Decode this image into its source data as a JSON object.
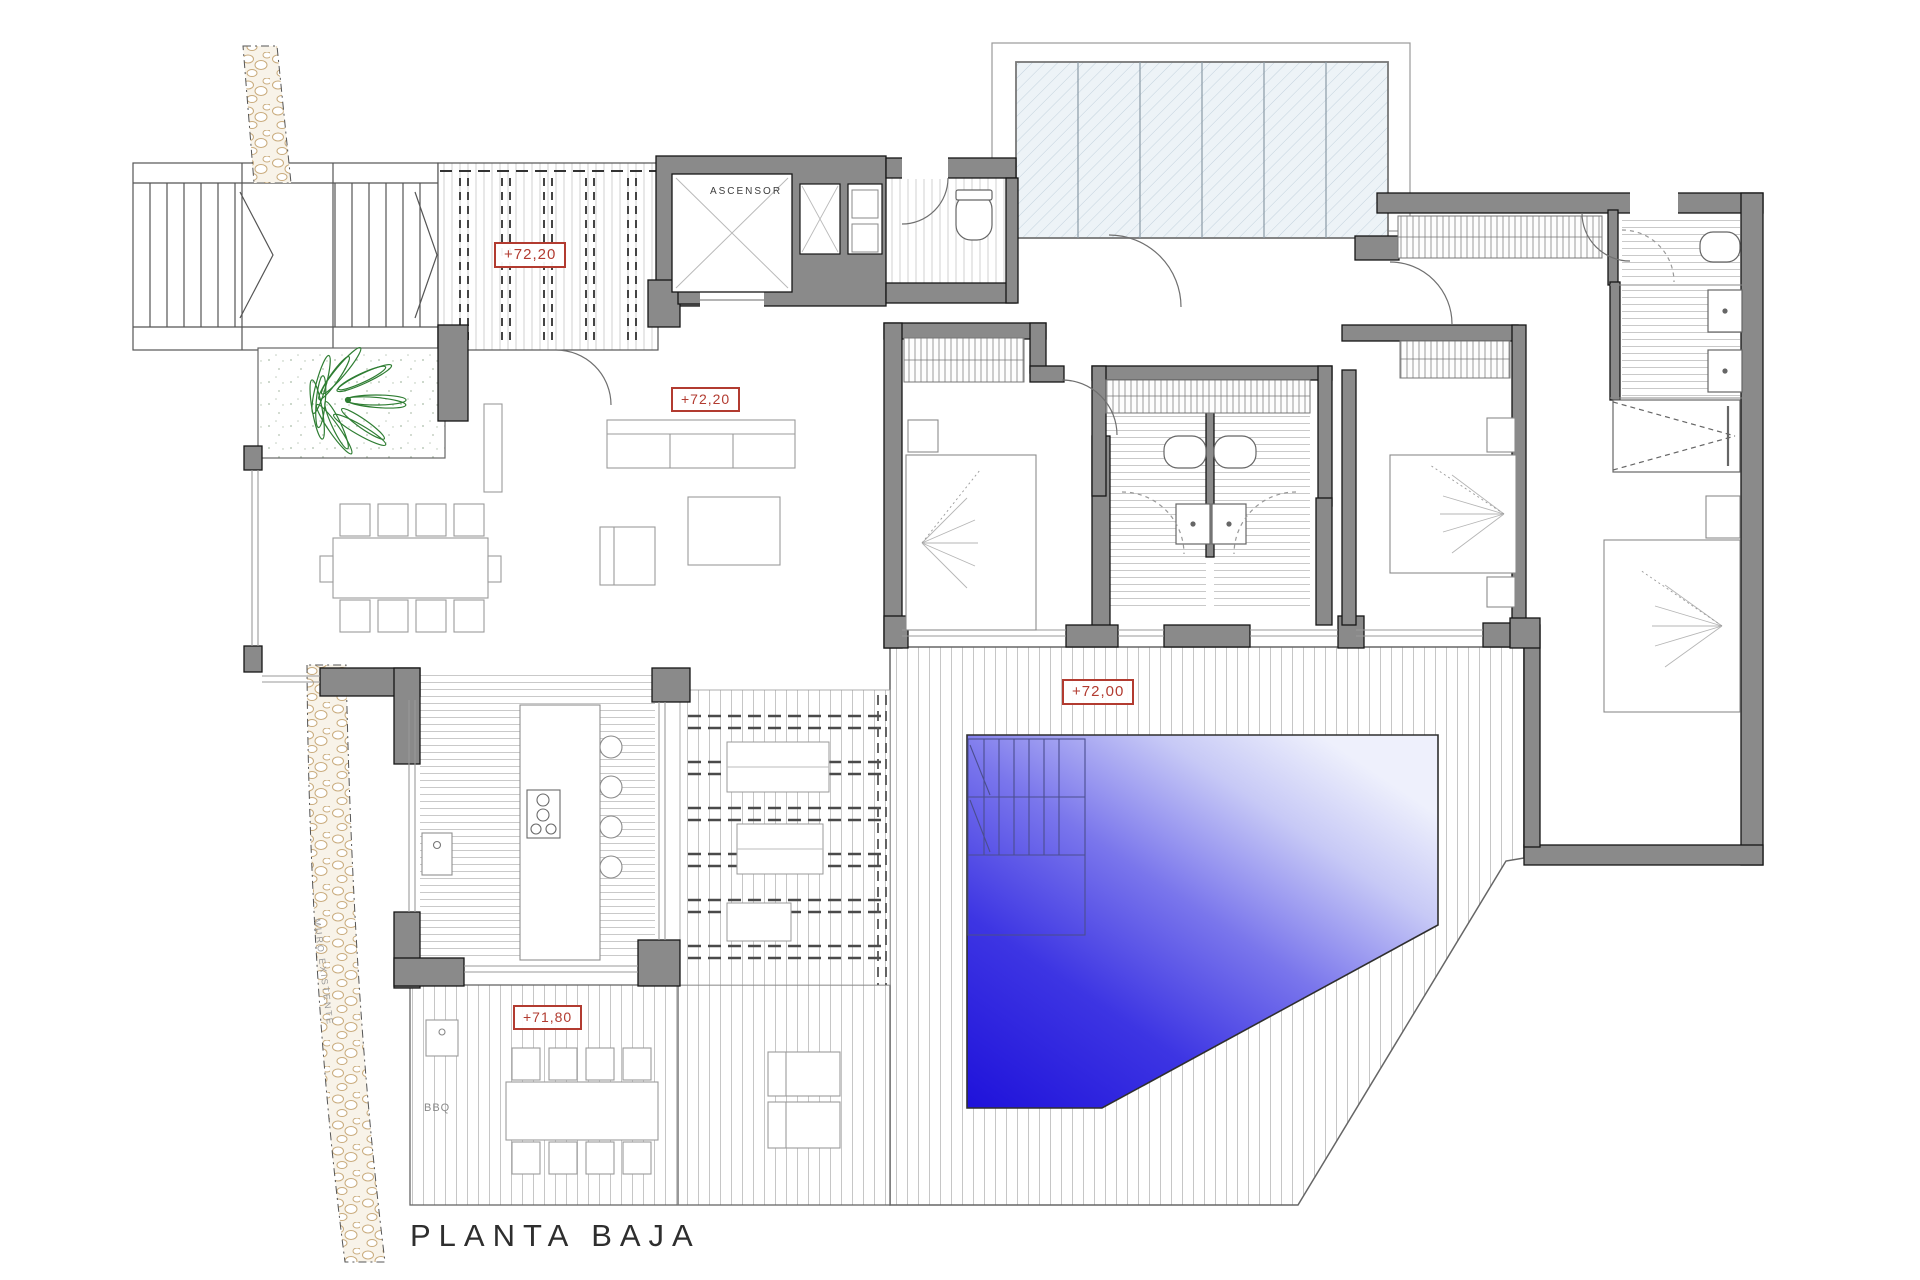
{
  "drawing": {
    "floor_title": "PLANTA BAJA",
    "elevator_label": "ASCENSOR",
    "bbq_label": "BBQ",
    "existing_wall_label": "MURO EXISTENTE",
    "levels": {
      "entry": "+72,20",
      "living": "+72,20",
      "pool_deck": "+72,00",
      "bbq_terrace": "+71,80"
    },
    "colors": {
      "wall_fill": "#8a8a8a",
      "wall_outline": "#161616",
      "level_marker_red": "#b23b30",
      "pool_deep_blue": "#2013dc",
      "pool_light_blue": "#eef0fc",
      "glass_fill": "#edf3f7",
      "plant_green": "#2e7d32",
      "pebble_tan": "#c9ab7c",
      "deck_line_gray": "#c6c6c6",
      "title_text": "#2e2e2e"
    }
  }
}
